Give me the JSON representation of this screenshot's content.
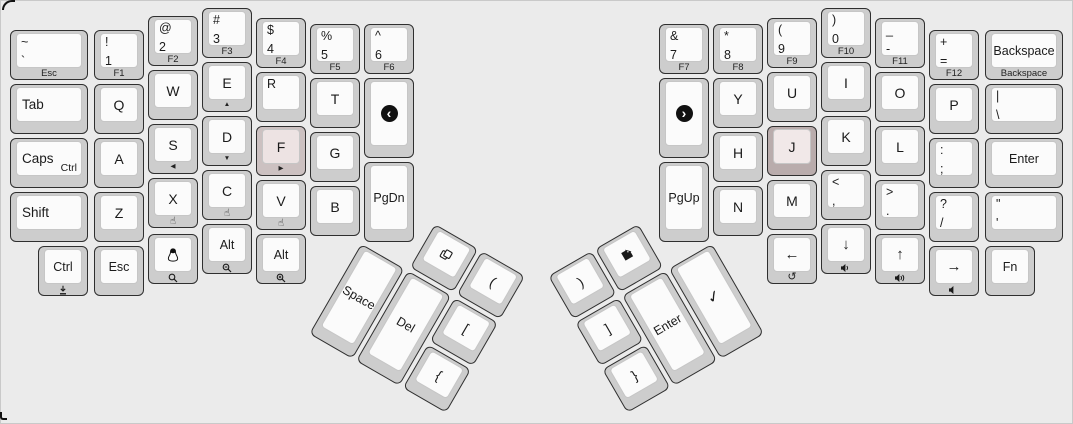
{
  "colors": {
    "background": "#ebebeb",
    "frame_border": "#c9c9c9",
    "key_base": "#cdcdcd",
    "key_top": "#fbfbfb",
    "key_border": "#2f2f2f",
    "legend": "#1b1b1b",
    "homing_light_base": "#ccc1c1",
    "homing_light_top": "#ede3e3",
    "homing_dark_base": "#b9acac",
    "homing_dark_top": "#f1e8e8"
  },
  "keyboard": {
    "left_main": {
      "keys": [
        {
          "id": "grave",
          "x": 10,
          "y": 30,
          "w": 78,
          "legends": {
            "tl": "~",
            "bl": "`"
          },
          "front": "Esc"
        },
        {
          "id": "1",
          "x": 94,
          "y": 30,
          "legends": {
            "tl": "!",
            "bl": "1"
          },
          "front": "F1"
        },
        {
          "id": "2",
          "x": 148,
          "y": 16,
          "legends": {
            "tl": "@",
            "bl": "2"
          },
          "front": "F2"
        },
        {
          "id": "3",
          "x": 202,
          "y": 8,
          "legends": {
            "tl": "#",
            "bl": "3"
          },
          "front": "F3"
        },
        {
          "id": "4",
          "x": 256,
          "y": 18,
          "legends": {
            "tl": "$",
            "bl": "4"
          },
          "front": "F4"
        },
        {
          "id": "5",
          "x": 310,
          "y": 24,
          "legends": {
            "tl": "%",
            "bl": "5"
          },
          "front": "F5"
        },
        {
          "id": "6",
          "x": 364,
          "y": 24,
          "legends": {
            "tl": "^",
            "bl": "6"
          },
          "front": "F6"
        },
        {
          "id": "tab",
          "x": 10,
          "y": 84,
          "w": 78,
          "legends": {
            "left": "Tab"
          }
        },
        {
          "id": "q",
          "x": 94,
          "y": 84,
          "legends": {
            "center": "Q"
          }
        },
        {
          "id": "w",
          "x": 148,
          "y": 70,
          "legends": {
            "center": "W"
          }
        },
        {
          "id": "e",
          "x": 202,
          "y": 62,
          "legends": {
            "center": "E"
          },
          "front_icon": "triangle-up"
        },
        {
          "id": "r",
          "x": 256,
          "y": 72,
          "legends": {
            "tl": "R"
          }
        },
        {
          "id": "t",
          "x": 310,
          "y": 78,
          "legends": {
            "center": "T"
          }
        },
        {
          "id": "browser-back",
          "x": 364,
          "y": 78,
          "h": 80,
          "center_icon": "circled-chevron-left"
        },
        {
          "id": "caps",
          "x": 10,
          "y": 138,
          "w": 78,
          "legends": {
            "left": "Caps",
            "br": "Ctrl"
          }
        },
        {
          "id": "a",
          "x": 94,
          "y": 138,
          "legends": {
            "center": "A"
          }
        },
        {
          "id": "s",
          "x": 148,
          "y": 124,
          "legends": {
            "center": "S"
          },
          "front_icon": "triangle-left"
        },
        {
          "id": "d",
          "x": 202,
          "y": 116,
          "legends": {
            "center": "D"
          },
          "front_icon": "triangle-down"
        },
        {
          "id": "f",
          "x": 256,
          "y": 126,
          "legends": {
            "center": "F"
          },
          "front_icon": "triangle-right",
          "color": "homing-light"
        },
        {
          "id": "g",
          "x": 310,
          "y": 132,
          "legends": {
            "center": "G"
          }
        },
        {
          "id": "shift",
          "x": 10,
          "y": 192,
          "w": 78,
          "legends": {
            "left": "Shift"
          }
        },
        {
          "id": "z",
          "x": 94,
          "y": 192,
          "legends": {
            "center": "Z"
          }
        },
        {
          "id": "x",
          "x": 148,
          "y": 178,
          "legends": {
            "center": "X"
          },
          "front_icon": "pointer-hand"
        },
        {
          "id": "c",
          "x": 202,
          "y": 170,
          "legends": {
            "center": "C"
          },
          "front_icon": "pointer-hand"
        },
        {
          "id": "v",
          "x": 256,
          "y": 180,
          "legends": {
            "center": "V"
          },
          "front_icon": "pointer-hand"
        },
        {
          "id": "b",
          "x": 310,
          "y": 186,
          "legends": {
            "center": "B"
          }
        },
        {
          "id": "pgdn",
          "x": 364,
          "y": 162,
          "h": 80,
          "legends": {
            "center": "PgDn"
          },
          "small": true
        },
        {
          "id": "ctrl-bottom",
          "x": 38,
          "y": 246,
          "legends": {
            "center": "Ctrl"
          },
          "small": true,
          "front_icon": "download"
        },
        {
          "id": "esc-bottom",
          "x": 94,
          "y": 246,
          "legends": {
            "center": "Esc"
          },
          "small": true
        },
        {
          "id": "super-tux",
          "x": 148,
          "y": 234,
          "center_icon": "tux",
          "front_icon": "search"
        },
        {
          "id": "alt-left-1",
          "x": 202,
          "y": 224,
          "legends": {
            "center": "Alt"
          },
          "small": true,
          "front_icon": "zoom-out"
        },
        {
          "id": "alt-left-2",
          "x": 256,
          "y": 234,
          "legends": {
            "center": "Alt"
          },
          "small": true,
          "front_icon": "zoom-in"
        }
      ]
    },
    "right_main": {
      "keys": [
        {
          "id": "7",
          "x": 659,
          "y": 24,
          "legends": {
            "tl": "&",
            "bl": "7"
          },
          "front": "F7"
        },
        {
          "id": "8",
          "x": 713,
          "y": 24,
          "legends": {
            "tl": "*",
            "bl": "8"
          },
          "front": "F8"
        },
        {
          "id": "9",
          "x": 767,
          "y": 18,
          "legends": {
            "tl": "(",
            "bl": "9"
          },
          "front": "F9"
        },
        {
          "id": "0",
          "x": 821,
          "y": 8,
          "legends": {
            "tl": ")",
            "bl": "0"
          },
          "front": "F10"
        },
        {
          "id": "minus",
          "x": 875,
          "y": 18,
          "legends": {
            "tl": "_",
            "bl": "-"
          },
          "front": "F11"
        },
        {
          "id": "equals",
          "x": 929,
          "y": 30,
          "legends": {
            "tl": "+",
            "bl": "="
          },
          "front": "F12"
        },
        {
          "id": "backspace",
          "x": 985,
          "y": 30,
          "w": 78,
          "legends": {
            "center": "Backspace"
          },
          "small": true,
          "front": "Backspace"
        },
        {
          "id": "browser-forward",
          "x": 659,
          "y": 78,
          "h": 80,
          "center_icon": "circled-chevron-right"
        },
        {
          "id": "y",
          "x": 713,
          "y": 78,
          "legends": {
            "center": "Y"
          }
        },
        {
          "id": "u",
          "x": 767,
          "y": 72,
          "legends": {
            "center": "U"
          }
        },
        {
          "id": "i",
          "x": 821,
          "y": 62,
          "legends": {
            "center": "I"
          }
        },
        {
          "id": "o",
          "x": 875,
          "y": 72,
          "legends": {
            "center": "O"
          }
        },
        {
          "id": "p",
          "x": 929,
          "y": 84,
          "legends": {
            "center": "P"
          }
        },
        {
          "id": "backslash",
          "x": 985,
          "y": 84,
          "w": 78,
          "legends": {
            "tl": "|",
            "bl": "\\"
          }
        },
        {
          "id": "h",
          "x": 713,
          "y": 132,
          "legends": {
            "center": "H"
          }
        },
        {
          "id": "j",
          "x": 767,
          "y": 126,
          "legends": {
            "center": "J"
          },
          "color": "homing-dark"
        },
        {
          "id": "k",
          "x": 821,
          "y": 116,
          "legends": {
            "center": "K"
          }
        },
        {
          "id": "l",
          "x": 875,
          "y": 126,
          "legends": {
            "center": "L"
          }
        },
        {
          "id": "semicolon",
          "x": 929,
          "y": 138,
          "legends": {
            "tl": ":",
            "bl": ";"
          }
        },
        {
          "id": "enter-main",
          "x": 985,
          "y": 138,
          "w": 78,
          "legends": {
            "center": "Enter"
          },
          "small": true
        },
        {
          "id": "pgup",
          "x": 659,
          "y": 162,
          "h": 80,
          "legends": {
            "center": "PgUp"
          },
          "small": true
        },
        {
          "id": "n",
          "x": 713,
          "y": 186,
          "legends": {
            "center": "N"
          }
        },
        {
          "id": "m",
          "x": 767,
          "y": 180,
          "legends": {
            "center": "M"
          }
        },
        {
          "id": "comma",
          "x": 821,
          "y": 170,
          "legends": {
            "tl": "<",
            "bl": ","
          }
        },
        {
          "id": "period",
          "x": 875,
          "y": 180,
          "legends": {
            "tl": ">",
            "bl": "."
          }
        },
        {
          "id": "slash",
          "x": 929,
          "y": 192,
          "legends": {
            "tl": "?",
            "bl": "/"
          }
        },
        {
          "id": "quote",
          "x": 985,
          "y": 192,
          "w": 78,
          "legends": {
            "tl": "\"",
            "bl": "'"
          }
        },
        {
          "id": "arrow-left",
          "x": 767,
          "y": 234,
          "legends": {
            "center": "←"
          },
          "arrow": true,
          "front_icon": "undo"
        },
        {
          "id": "arrow-down",
          "x": 821,
          "y": 224,
          "legends": {
            "center": "↓"
          },
          "arrow": true,
          "front_icon": "volume-down"
        },
        {
          "id": "arrow-up",
          "x": 875,
          "y": 234,
          "legends": {
            "center": "↑"
          },
          "arrow": true,
          "front_icon": "volume-up"
        },
        {
          "id": "arrow-right",
          "x": 929,
          "y": 246,
          "legends": {
            "center": "→"
          },
          "arrow": true,
          "front_icon": "mute"
        },
        {
          "id": "fn",
          "x": 985,
          "y": 246,
          "legends": {
            "center": "Fn"
          },
          "small": true
        }
      ]
    },
    "left_thumb": {
      "origin_x": 435,
      "origin_y": 224,
      "rotation": 30,
      "keys": [
        {
          "id": "copy",
          "x": 0,
          "y": 0,
          "center_icon": "copy"
        },
        {
          "id": "lparen",
          "x": 54,
          "y": 0,
          "legends": {
            "center": "("
          }
        },
        {
          "id": "lbracket",
          "x": 54,
          "y": 54,
          "legends": {
            "center": "["
          }
        },
        {
          "id": "lbrace",
          "x": 54,
          "y": 108,
          "legends": {
            "center": "{"
          }
        },
        {
          "id": "del",
          "x": 0,
          "y": 54,
          "h": 104,
          "legends": {
            "center": "Del"
          },
          "small": true
        },
        {
          "id": "space",
          "x": -54,
          "y": 54,
          "h": 104,
          "legends": {
            "center": "Space"
          },
          "small": true
        }
      ]
    },
    "right_thumb": {
      "origin_x": 595,
      "origin_y": 249,
      "rotation": -30,
      "keys": [
        {
          "id": "paste",
          "x": 0,
          "y": 0,
          "center_icon": "paste"
        },
        {
          "id": "rparen",
          "x": -54,
          "y": 0,
          "legends": {
            "center": ")"
          }
        },
        {
          "id": "rbracket",
          "x": -54,
          "y": 54,
          "legends": {
            "center": "]"
          }
        },
        {
          "id": "rbrace",
          "x": -54,
          "y": 108,
          "legends": {
            "center": "}"
          }
        },
        {
          "id": "enter-thumb",
          "x": 0,
          "y": 54,
          "h": 104,
          "legends": {
            "center": "Enter"
          },
          "small": true
        },
        {
          "id": "check",
          "x": 54,
          "y": 54,
          "h": 104,
          "center_icon": "check"
        }
      ]
    }
  }
}
